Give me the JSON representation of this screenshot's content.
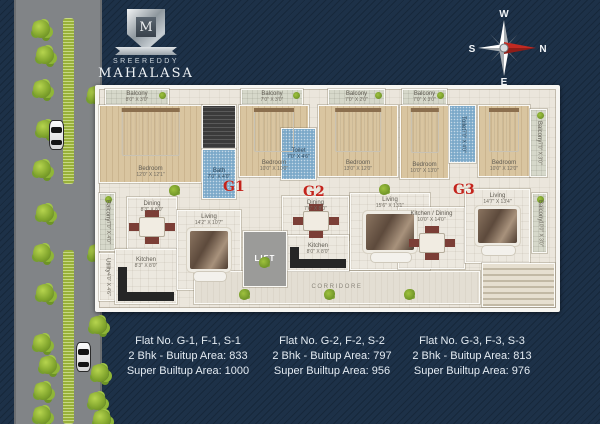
{
  "logo": {
    "monogram": "M",
    "brand_top": "SREEREDDY",
    "brand_name": "MAHALASA"
  },
  "compass": {
    "west": "W",
    "north": "N",
    "east": "E",
    "south": "S"
  },
  "floorplan": {
    "unit_labels": [
      {
        "id": "g1",
        "text": "G1",
        "x": 124,
        "y": 90
      },
      {
        "id": "g2",
        "text": "G2",
        "x": 204,
        "y": 95
      },
      {
        "id": "g3",
        "text": "G3",
        "x": 354,
        "y": 93
      }
    ],
    "rooms": [
      {
        "id": "g1-balcony-top-1",
        "label": "Balcony",
        "dims": "8'0\" X 3'0\"",
        "type": "balcony",
        "x": 6,
        "y": 0,
        "w": 64,
        "h": 16
      },
      {
        "id": "g1-bedroom-1",
        "label": "Bedroom",
        "dims": "12'0\" X 12'1\"",
        "type": "wood",
        "furniture": "bed",
        "x": 0,
        "y": 16,
        "w": 103,
        "h": 78
      },
      {
        "id": "g1-wardrobe",
        "label": "",
        "dims": "",
        "type": "dark",
        "x": 103,
        "y": 16,
        "w": 34,
        "h": 44
      },
      {
        "id": "g1-bath",
        "label": "Bath",
        "dims": "7'0\" X 4'0\"",
        "type": "blue",
        "x": 103,
        "y": 60,
        "w": 34,
        "h": 50
      },
      {
        "id": "g1-balcony-top-2",
        "label": "Balcony",
        "dims": "7'0\" X 3'0\"",
        "type": "balcony",
        "x": 142,
        "y": 0,
        "w": 62,
        "h": 16
      },
      {
        "id": "g1-bedroom-2",
        "label": "Bedroom",
        "dims": "10'0\" X 10'0\"",
        "type": "wood",
        "furniture": "bed",
        "x": 140,
        "y": 16,
        "w": 70,
        "h": 72
      },
      {
        "id": "g1-sitout",
        "label": "Balcony",
        "dims": "7'0\" X 4'0\"",
        "type": "balcony",
        "vert": true,
        "x": 0,
        "y": 104,
        "w": 16,
        "h": 58
      },
      {
        "id": "g1-utility",
        "label": "Utility",
        "dims": "4'0\" X 4'6\"",
        "type": "tile",
        "vert": true,
        "x": 0,
        "y": 164,
        "w": 16,
        "h": 48
      },
      {
        "id": "g1-dining",
        "label": "Dining",
        "dims": "8'3\" X 8'0\"",
        "type": "tile",
        "furniture": "table",
        "x": 28,
        "y": 108,
        "w": 50,
        "h": 52
      },
      {
        "id": "g1-kitchen",
        "label": "Kitchen",
        "dims": "8'3\" X 8'0\"",
        "type": "tile",
        "furniture": "counter",
        "x": 16,
        "y": 160,
        "w": 62,
        "h": 55
      },
      {
        "id": "g1-living",
        "label": "Living",
        "dims": "14'2\" X 10'7\"",
        "type": "tile",
        "furniture": "rug",
        "x": 78,
        "y": 121,
        "w": 64,
        "h": 80
      },
      {
        "id": "corridor",
        "label": "CORRIDORE",
        "dims": "",
        "type": "corridor",
        "x": 95,
        "y": 182,
        "w": 286,
        "h": 33
      },
      {
        "id": "g2-toilet",
        "label": "Toilet",
        "dims": "7'0\" X 4'6\"",
        "type": "blue",
        "x": 182,
        "y": 39,
        "w": 35,
        "h": 52
      },
      {
        "id": "g2-balcony-top",
        "label": "Balcony",
        "dims": "7'0\" X 2'0\"",
        "type": "balcony",
        "x": 229,
        "y": 0,
        "w": 57,
        "h": 16
      },
      {
        "id": "g2-bedroom",
        "label": "Bedroom",
        "dims": "13'0\" X 12'0\"",
        "type": "wood",
        "furniture": "bed",
        "x": 219,
        "y": 16,
        "w": 80,
        "h": 72
      },
      {
        "id": "g2-dining",
        "label": "Dining",
        "dims": "7'6\" X 8'0\"",
        "type": "tile",
        "furniture": "table",
        "x": 183,
        "y": 107,
        "w": 67,
        "h": 44
      },
      {
        "id": "g2-living",
        "label": "Living",
        "dims": "15'6\" X 13'1\"",
        "type": "tile",
        "furniture": "rug",
        "x": 251,
        "y": 104,
        "w": 80,
        "h": 77
      },
      {
        "id": "g2-kitchen",
        "label": "Kitchen",
        "dims": "8'0\" X 8'0\"",
        "type": "tile",
        "furniture": "counter",
        "x": 188,
        "y": 146,
        "w": 62,
        "h": 36
      },
      {
        "id": "lift",
        "label": "LIFT",
        "dims": "",
        "type": "lift",
        "x": 144,
        "y": 142,
        "w": 44,
        "h": 56
      },
      {
        "id": "g3-balcony-top",
        "label": "Balcony",
        "dims": "7'0\" X 3'0\"",
        "type": "balcony",
        "x": 303,
        "y": 0,
        "w": 45,
        "h": 16
      },
      {
        "id": "g3-bedroom-1",
        "label": "Bedroom",
        "dims": "10'0\" X 13'0\"",
        "type": "wood",
        "furniture": "bed",
        "x": 301,
        "y": 16,
        "w": 49,
        "h": 74
      },
      {
        "id": "g3-toilet",
        "label": "Toilet",
        "dims": "7'0\" X 4'0\"",
        "type": "blue",
        "vert": true,
        "x": 350,
        "y": 16,
        "w": 27,
        "h": 58
      },
      {
        "id": "g3-bedroom-2",
        "label": "Bedroom",
        "dims": "10'0\" X 12'0\"",
        "type": "wood",
        "furniture": "bed",
        "x": 379,
        "y": 16,
        "w": 52,
        "h": 72
      },
      {
        "id": "g3-balcony-right-top",
        "label": "Balcony",
        "dims": "7'0\" X 3'0\"",
        "type": "balcony",
        "vert": true,
        "x": 431,
        "y": 20,
        "w": 17,
        "h": 68
      },
      {
        "id": "g3-kitchen-dining",
        "label": "Kitchen / Dining",
        "dims": "10'0\" X 14'0\"",
        "type": "tile",
        "furniture": "table",
        "x": 299,
        "y": 118,
        "w": 67,
        "h": 62
      },
      {
        "id": "g3-living",
        "label": "Living",
        "dims": "14'7\" X 13'4\"",
        "type": "tile",
        "furniture": "rug",
        "x": 366,
        "y": 100,
        "w": 65,
        "h": 74
      },
      {
        "id": "g3-balcony-right-bottom",
        "label": "Balcony",
        "dims": "10'0\" X 3'0\"",
        "type": "balcony",
        "vert": true,
        "x": 433,
        "y": 104,
        "w": 15,
        "h": 60
      },
      {
        "id": "stairs",
        "label": "",
        "dims": "",
        "type": "stairs",
        "x": 383,
        "y": 174,
        "w": 73,
        "h": 44
      }
    ],
    "plants": [
      {
        "x": 70,
        "y": 96
      },
      {
        "x": 160,
        "y": 168
      },
      {
        "x": 280,
        "y": 95
      },
      {
        "x": 140,
        "y": 200
      },
      {
        "x": 225,
        "y": 200
      },
      {
        "x": 305,
        "y": 200
      }
    ]
  },
  "environment": {
    "trees": [
      {
        "x": 32,
        "y": 20
      },
      {
        "x": 36,
        "y": 46
      },
      {
        "x": 33,
        "y": 80
      },
      {
        "x": 36,
        "y": 120
      },
      {
        "x": 33,
        "y": 160
      },
      {
        "x": 36,
        "y": 204
      },
      {
        "x": 33,
        "y": 244
      },
      {
        "x": 36,
        "y": 284
      },
      {
        "x": 33,
        "y": 334
      },
      {
        "x": 39,
        "y": 356
      },
      {
        "x": 34,
        "y": 382
      },
      {
        "x": 33,
        "y": 406
      },
      {
        "x": 87,
        "y": 86
      },
      {
        "x": 88,
        "y": 244
      },
      {
        "x": 89,
        "y": 316
      },
      {
        "x": 91,
        "y": 364
      },
      {
        "x": 88,
        "y": 392
      },
      {
        "x": 93,
        "y": 410
      }
    ],
    "cars": [
      {
        "x": 49,
        "y": 120
      },
      {
        "x": 76,
        "y": 342
      }
    ]
  },
  "flats": [
    {
      "line1": "Flat No. G-1, F-1, S-1",
      "line2": "2 Bhk - Buitup Area: 833",
      "line3": "Super Builtup Area: 1000"
    },
    {
      "line1": "Flat No. G-2, F-2, S-2",
      "line2": "2 Bhk - Buitup Area: 797",
      "line3": "Super Builtup Area: 956"
    },
    {
      "line1": "Flat No. G-3, F-3, S-3",
      "line2": "2 Bhk - Buitup Area: 813",
      "line3": "Super Builtup Area: 976"
    }
  ]
}
